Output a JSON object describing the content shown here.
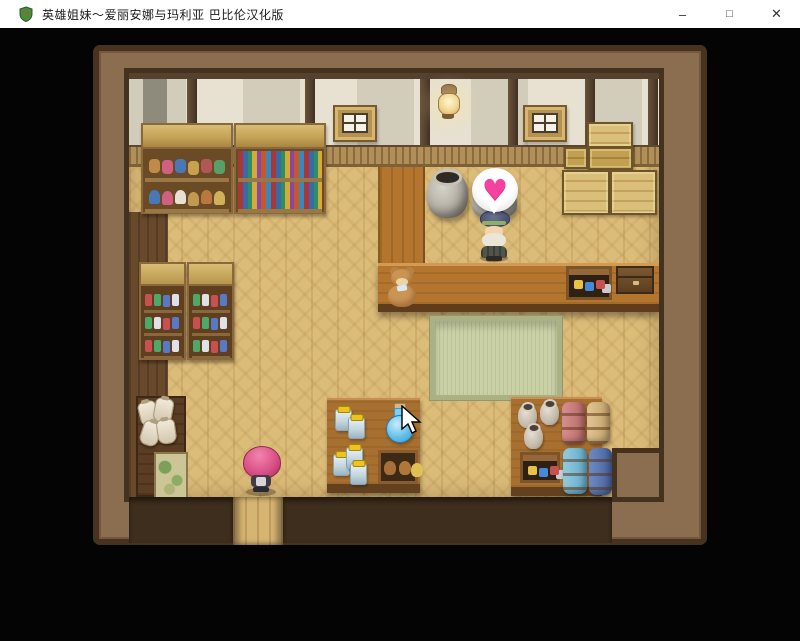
{
  "window": {
    "title": "英雄姐妹～爱丽安娜与玛利亚 巴比伦汉化版",
    "controls": {
      "minimize": "–",
      "maximize": "□",
      "close": "✕"
    }
  },
  "game": {
    "scene": "shop-interior",
    "emote_heart": "♥",
    "colors": {
      "background": "#040404",
      "titlebar": "#ffffff",
      "room_wall": "#8b6d50",
      "wall_panel": "#e2ddcd",
      "floor": "#dcbc79",
      "counter": "#b4762f",
      "tatami": "#cbd1a7",
      "heart": "#f5429e",
      "player_hair": "#d94f85",
      "bale_blue": "#46609c",
      "bale_pink": "#b86868"
    }
  }
}
